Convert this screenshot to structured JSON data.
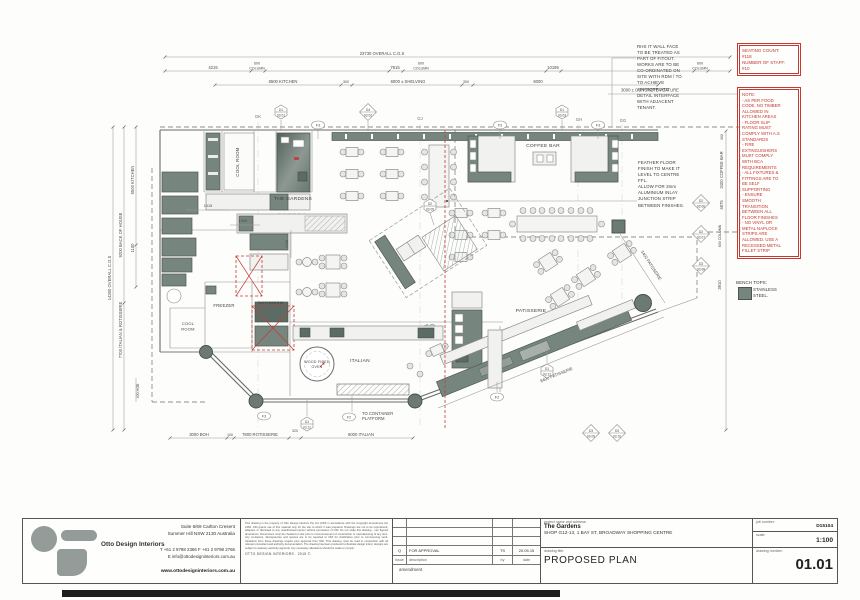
{
  "plan": {
    "grid": {
      "gk": "GK",
      "gj": "GJ",
      "gh": "GH",
      "gg": "GG"
    },
    "rooms": {
      "cool_room_top": "COOL ROOM",
      "the_gardens": "THE GARDENS",
      "coffee_bar": "COFFEE BAR",
      "freezer": "FREEZER",
      "cool_left_1": "COOL",
      "cool_left_2": "ROOM",
      "rotisserie": "ROTISSERIE",
      "oven_1": "WOOD FIRED",
      "oven_2": "OVEN",
      "italian": "ITALIAN",
      "patisserie": "PATISSERIE"
    },
    "dims_top": {
      "overall": "23730 OVERALL C.O.S",
      "a": "4215",
      "b": "7815",
      "c": "10195",
      "col6": "600",
      "col": "COLUMN",
      "kitchen": "6500 KITCHEN",
      "s300": "300",
      "shelving": "6000 ± SHELVING",
      "d6000": "6000",
      "concrete": "3000 ± CONCRETE FEATURE"
    },
    "dims_left": {
      "overall": "14300 OVERALL C.O.S",
      "boh": "9200 BACK OF HOUSE",
      "italrot": "7700 ITALIAN & ROTISSERIE",
      "kitchen": "5500 KITCHEN",
      "d1100": "1100",
      "hob": "400 HOB"
    },
    "dims_right": {
      "d300": "300",
      "coffee": "3400 COFFEE BAR",
      "d4875": "4875",
      "col600": "600 COLUMN",
      "d3910": "3910"
    },
    "dims_bottom": {
      "boh": "3000 BOH",
      "d100": "100",
      "rot": "7800 ROTISSERIE",
      "d320": "320",
      "ital": "6000 ITALIAN"
    },
    "dims_inner": {
      "d1015": "1015",
      "d1000": "1000",
      "d1100": "1100",
      "pat3400": "3400 PATISSERIE",
      "pat8400": "8400 PATISSERIE"
    },
    "bubbles": {
      "d1": "D1",
      "d2": "D2",
      "d3": "D3",
      "d4": "D4",
      "f3": "F3",
      "f2": "F2",
      "c01": "03.01",
      "c02": "03.02",
      "c03": "03.03",
      "c05": "03.05",
      "c06": "03.06",
      "c07": "03.07",
      "c08": "03.08",
      "c09": "03.09",
      "c10": "03.10",
      "c11": "03.11",
      "c12": "03.12"
    },
    "notes": {
      "rhs": "RHS IT WALL FACE\nTO BE TREATED AS\nPART OF FITOUT.\nWORKS ARE TO BE\nCO-ORDINATED ON\nSITE WITH RDM / TO\nTO ACHIEVE\nAPPROPRIATE\nDETAIL INTERFACE\nWITH ADJACENT\nTENANT.",
      "feather": "FEATHER FLOOR\nFINISH TO MAKE IT\nLEVEL TO CENTRE\nFFL.\nALLOW FOR 3mm\nALUMINIUM INLAY\nJUNCTION STRIP\nBETWEEN FINISHES.",
      "container_1": "TO CONTAINER",
      "container_2": "PLATFORM"
    },
    "red": {
      "seating": "SEATING COUNT:\n#118\nNUMBER OF STAFF:\n#10",
      "note": "NOTE:\n- AS PER FOOD\nCODE, NO TIMBER\nALLOWED IN\nKITCHEN AREAS\n- FLOOR SLIP\nRATING MUST\nCOMPLY WITH A.S\nSTANDARDS\n- FIRE\nEXTINGUISHERS\nMUST COMPLY\nWITH BCA\nREQUIREMENTS\n- ALL FIXTURES &\nFITTINGS ARE TO\nBE SELF\nSUPPORTING\n- ENSURE\nSMOOTH\nTRANSITION\nBETWEEN ALL\nFLOOR FINISHES\n- NO VINYL OR\nMETAL NAPLOCK\nSTRIPS ARE\nALLOWED. USE A\nRECESSED METAL\nFILLET STRIP"
    },
    "legend": {
      "title": "BENCH TOPS:",
      "item": "STAINLESS\nSTEEL."
    }
  },
  "titleblock": {
    "company": "Otto Design Interiors",
    "address": "Suite 6/69 Carlton Cresent\nSummer Hill NSW 2130 Australia",
    "contact": "T +61 2 9798 2366   F +61 2 9798 2766\nE info@ottodesigninteriors.com.au",
    "web": "www.ottodesigninteriors.com.au",
    "disclaimer": "This drawing is the property of Otto Design Interiors Pty Ltd (ODI) in accordance with the Copyright Amendment Act 1984. ODI grants use of this material only for the site to which it was prepared. Drawings are not to be reproduced, adapted, or disclosed to any unauthorised person without permission of ODI. Do not scale this drawing - use figured dimensions. Dimensions must be checked on site prior to commencement of construction or manufacturing of any item. Any omissions, discrepancies and queries are to be reported to ODI for clarification prior to commencing work. Variations from these drawings require prior approval from ODI. This drawing must be read in conjunction with all relevant consultant and authority documentation. The drawing has been produced to illustrate design intent; designs are subject to statutory authority approval. Any necessary alterations should be made to comply.",
    "copyright": "OTTO DESIGN INTERIORS . 2015 ©",
    "amendment": {
      "row_issue": "Q",
      "row_desc": "FOR APPROVAL",
      "row_by": "TS",
      "row_date": "20.05.15",
      "issue_h": "issue",
      "desc_h": "description",
      "by_h": "by",
      "date_h": "date",
      "footer": "amendment"
    },
    "project": {
      "label": "project name and address:",
      "name": "The Gardens",
      "address": "SHOP G12-13, 1 BAY ST, BROADWAY SHOPPING CENTRE"
    },
    "drawing": {
      "label": "drawing title:",
      "title": "PROPOSED PLAN"
    },
    "job": {
      "label": "job number:",
      "value": "D15104"
    },
    "scale": {
      "label": "scale:",
      "value": "1:100"
    },
    "number": {
      "label": "drawing number:",
      "value": "01.01"
    }
  }
}
